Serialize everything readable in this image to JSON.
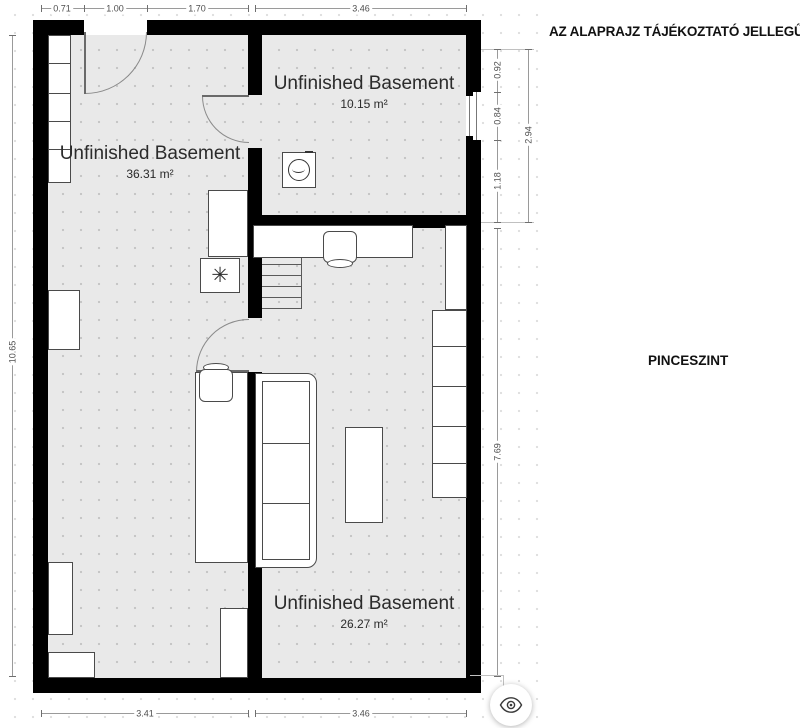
{
  "side_panel": {
    "disclaimer": "AZ ALAPRAJZ TÁJÉKOZTATÓ JELLEGŰ!",
    "floor_label": "PINCESZINT"
  },
  "rooms": [
    {
      "name": "Unfinished Basement",
      "area": "36.31 m²"
    },
    {
      "name": "Unfinished Basement",
      "area": "10.15 m²"
    },
    {
      "name": "Unfinished Basement",
      "area": "26.27 m²"
    }
  ],
  "dimensions": {
    "top": [
      "0.71",
      "1.00",
      "1.70",
      "3.46"
    ],
    "left": [
      "10.65"
    ],
    "right_upper": [
      "0.92",
      "0.84",
      "1.18"
    ],
    "right_outer": "2.94",
    "right_lower": "7.69",
    "bottom": [
      "3.41",
      "3.46"
    ]
  },
  "glyphs": {
    "furnace": "✳"
  },
  "colors": {
    "wall": "#000000",
    "floor": "#e9e9e9",
    "floor_dot": "#c6c6c6",
    "furniture_stroke": "#4a4a4a",
    "dimension_text": "#4e4e4e",
    "room_text": "#2b2b2b"
  }
}
